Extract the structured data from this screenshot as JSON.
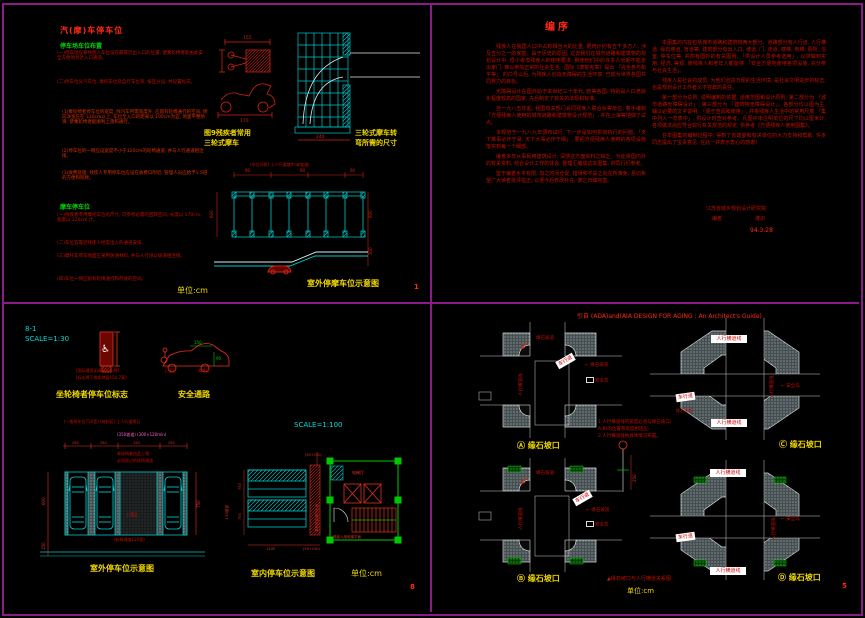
{
  "p1": {
    "title": "汽(摩)车停车位",
    "h1": "停车场车位布置",
    "pa": "(一)停车场应将残疾人车位设在最靠近出入口的位置, 使乘轮椅者能由此安全方便地到达入口通道。",
    "pb": "(二)停车位分汽车位, 摩托车位及自行车位等, 按区分设, 并设置标志。",
    "pc": "(1)乘轮椅者停车位的宽度, 除汽车所需宽度外, 应留有轮椅通行的空间, 侧向净宽应在 330cm以上, 车位至入口的距离以 100cm为宜, 地面平整防滑, 使乘轮椅者能顺利上落和通行。",
    "pd": "(2)停车位的一侧应设宽度不小于120cm的轮椅通道, 并与人行通道相连接。",
    "pe": "(3)收费处理: 残疾人专用停车位应设在收费口附近, 管理人员应给予1.5倍的方便和照顾。",
    "h2": "摩车停车位",
    "pf": "(一)残疾者专用摩托车位的尺寸, 可参考必需的回转空间, 长度以 170cm, 宽度以 220cm 计。",
    "pg": "(二)车位宜靠近残疾人经常出入的通道安排。",
    "ph": "(三)摩托车停车地面应采用防滑材料, 并与人行道以坡道相连接。",
    "pi": "(四)车位一侧应留有轮椅通行和存放的空间。",
    "fig1a": "图9残疾者常用",
    "fig1b": "三轮式摩车",
    "fig2a": "三轮式摩车转",
    "fig2b": "弯所需的尺寸",
    "lab_top": "(车位间距)  上人行道踏步(或坡道)",
    "cap": "室外停摩车位示意图",
    "unit": "单位:cm",
    "pn": "1",
    "d_mw": "155",
    "d_ml": "170",
    "d_gw": "240",
    "d_s": "90",
    "d_dep": "600",
    "d_rd": "300"
  },
  "p2": {
    "title": "编序",
    "c1p1": "残疾人在我国人口中占有相当大的比重, 据统计约有五千多万人, 涉及五分之一的家庭。由于历史的原因, 过去我们在城市道路和建筑物的规划设计中, 很少考虑残疾人的使用要求, 致使他们中的许多人长期不能走出家门, 难以参加正常的社会生活。国际《康复宪章》提出 「完全参与和平等」 的口号以后, 为残疾人创造无障碍的生活环境, 已成为世界各国共同努力的目标。",
    "c1p2": "无障碍设计在国外始于本世纪三十年代, 欧美各国, 特别是人口老龄化程度较高的国家, 先后制定了有关的法规和标准。",
    "c1p3": "自一九八五年起, 我国有关部门会同残疾人联合会等单位, 着手编制 「方便残疾人使用的城市道路和建筑物设计规范」, 并在上海等地做了试点。",
    "c1p4": "本规范于一九八九年颁布试行, 下一步是如何贯彻执行的问题。「天下难事必作于易, 天下大事必作于细」, 要把方便残疾人使用的各项设施落实到每一个细部。",
    "c1p5": "编者多年从事民用建筑设计, 深感这方面资料之缺乏。为此将国内外的有关资料, 结合设计工作的体会, 整理汇编成这本图集, 供同行们参考。",
    "c1p6": "鉴于编者水平有限, 加之时间仓促, 错误和不妥之处在所难免, 恳切希望广大读者批评指正, 以便今后修改补充, 使之日臻完善。",
    "c2p1": "本图集的内容包括城市道路和建筑物两大部分。道路部分有人行道, 人行横道, 缘石坡道, 盲道等; 建筑部分有出入口, 坡道, 门, 走道, 楼梯, 电梯, 厕所, 浴室, 停车位等, 并附有国外的有关图例, 「供设计人员参考选用」, 以求做到实用, 经济, 美观, 使残疾人和老年人都能够 「安全方便地使用各项设施, 充分参与社会生活」。",
    "c2p2": "残疾人是社会的成员, 为他们创造方便的生活环境, 是社会文明进步的标志, 也是规划设计工作者义不容辞的责任。",
    "c2p3": "第一部分为总则, 说明编制的依据, 适用范围和设计原则; 第二部分为 「城市道路无障碍设计」; 第三部分为 「建筑物无障碍设计」。各部分均以图为主, 辅以必要的文字说明, 「便于查阅和使用」, 并将残疾人生活中的常用尺度 「集中列入一览表中」, 供设计时查对参考。凡图中未注明单位的尺寸均以厘米计, 各项做法尚应符合现行有关规范的规定, 供参考《方便残疾人使用图集》。",
    "c2p4": "在本图集的编制过程中, 得到了省建委和有关单位的大力支持和帮助, 许多同志提出了宝贵意见, 在此一并表示衷心的感谢!",
    "sig1": "江苏省城乡规划设计研究院",
    "sig2": "编者",
    "sig3": "谨识",
    "date": "94.3.28"
  },
  "p8": {
    "lab": "8-1",
    "sc1": "SCALE=1:30",
    "sc2": "SCALE=1:100",
    "sdim1": "(国际通用无障碍标志牌)",
    "sdim2": "[标志牌下缘距地面150.7高]",
    "cap_sign": "坐轮椅者停车位标志",
    "cap_safe": "安全通路",
    "g1": "150",
    "g2": "90",
    "lab_a": "上落区",
    "lab_b": "乘降区",
    "t1": "(一般停车位750宽) (装卸区) 上人行道缘石",
    "t2": "(350坡道) (300×120min)",
    "t3": "乘轮椅者由此上落",
    "t4": "必须经过的轮椅通道",
    "aisle": "上落区",
    "under": "(轮椅通道120宽)",
    "cap_out": "室外停车位示意图",
    "cap_in": "室内停车位示意图",
    "walk": "乘轮椅者通行走道",
    "ramp": "1:50坡道",
    "lift": "电梯厅",
    "lift2": "残疾人用电梯平面",
    "d1": "250",
    "d2": "250",
    "d3": "120",
    "d4": "250",
    "d5": "600",
    "d6": "150",
    "d7": "750",
    "d8": "750",
    "d9": "1200",
    "d10": "(50+150)",
    "unit": "单位:cm",
    "pn": "8"
  },
  "p5": {
    "title": "引自 (ADA)and(AIA DESIGN FOR AGING : An Architect's Guide)",
    "road": "车行道",
    "cross": "人行横道线",
    "ramp": "缘石坡道",
    "island": "安全岛",
    "arr": "←",
    "n1": "1.人行横道线的宽度必须与缘石坡口(",
    "n2": "  A,B)的位置和宽度相适应;",
    "n3": "2.人行横道线依具体情况布置。",
    "d1": "250",
    "cA": "Ⓐ",
    "cB": "Ⓑ",
    "cC": "Ⓒ",
    "cD": "Ⓓ",
    "ct": "缘石坡口",
    "note": "▲缘石坡口与人行横道关系图",
    "unit": "单位:cm",
    "pn": "5"
  }
}
